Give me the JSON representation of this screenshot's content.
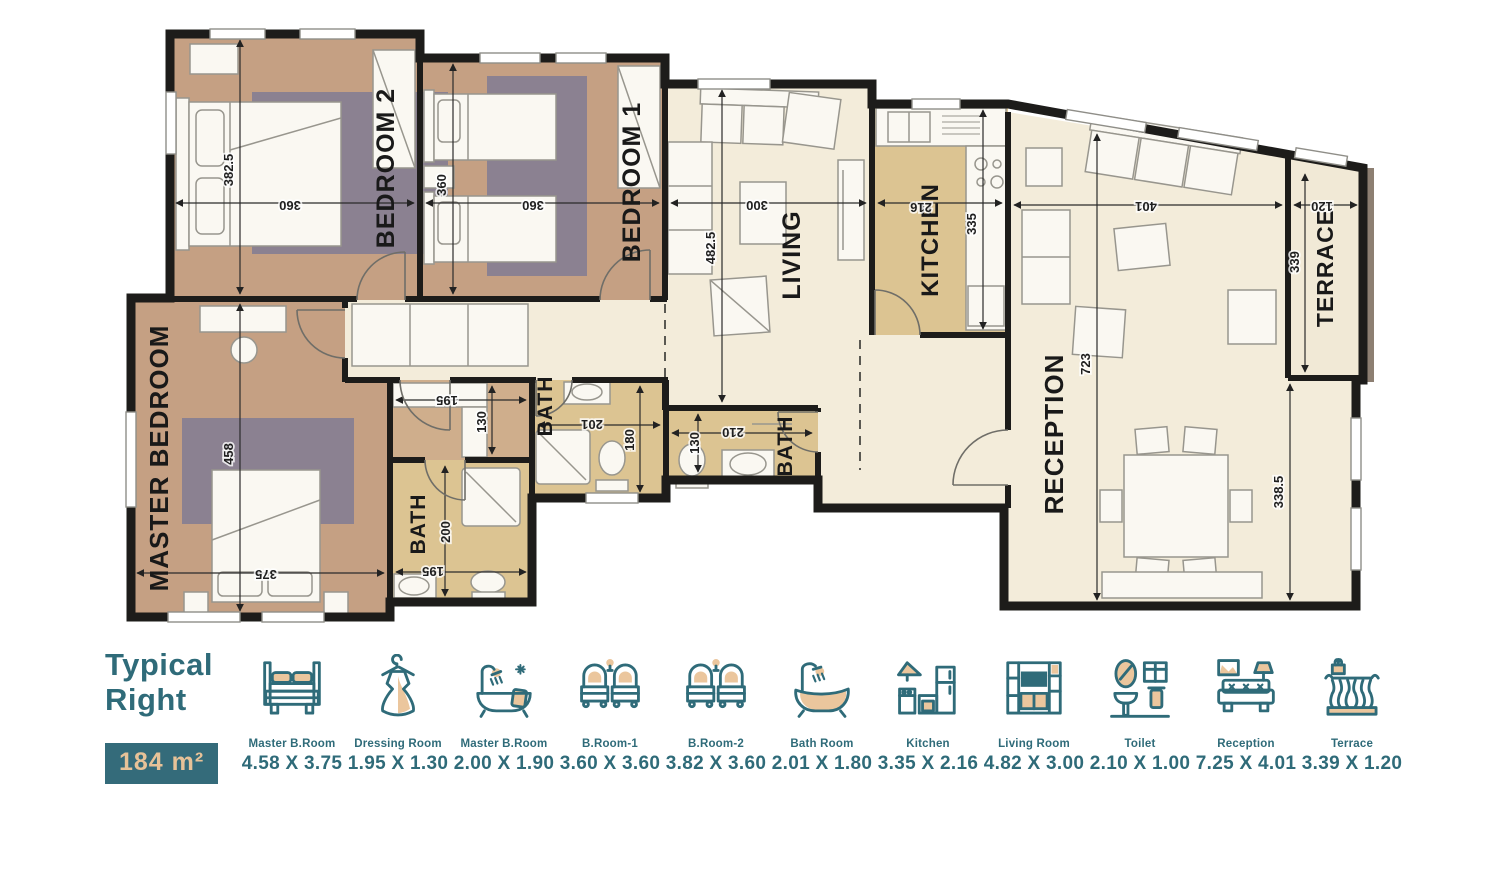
{
  "title": {
    "line1": "Typical",
    "line2": "Right",
    "area": "184 m²"
  },
  "floor_plan": {
    "room_labels": {
      "bedroom2": "BEDROOM 2",
      "bedroom1": "BEDROOM 1",
      "living": "LIVING",
      "kitchen": "KITCHEN",
      "reception": "RECEPTION",
      "terrace": "TERRACE",
      "master_bedroom": "MASTER BEDROOM",
      "master_bath": "BATH",
      "bath1": "BATH",
      "bath2": "BATH"
    },
    "dimensions": {
      "bedroom2_v": "382.5",
      "bedroom2_h": "360",
      "bedroom1_v": "360",
      "bedroom1_h": "360",
      "living_v": "482.5",
      "living_h": "300",
      "kitchen_h": "216",
      "kitchen_v": "335",
      "reception_h": "401",
      "reception_v": "723",
      "reception_v2": "338.5",
      "terrace_h": "120",
      "terrace_v": "339",
      "master_v": "458",
      "master_h": "375",
      "dressing_h": "195",
      "dressing_v": "130",
      "mbath_v": "200",
      "mbath_h": "195",
      "bath1_h": "201",
      "bath1_v": "180",
      "bath2_v": "130",
      "bath2_h": "210"
    }
  },
  "legend": {
    "items": [
      {
        "icon": "double-bed-icon",
        "name": "Master B.Room",
        "size": "4.58 X 3.75"
      },
      {
        "icon": "dress-icon",
        "name": "Dressing Room",
        "size": "1.95 X 1.30"
      },
      {
        "icon": "bathtub-shower-icon",
        "name": "Master B.Room",
        "size": "2.00 X 1.90"
      },
      {
        "icon": "twin-beds-icon",
        "name": "B.Room-1",
        "size": "3.60 X 3.60"
      },
      {
        "icon": "twin-beds-icon",
        "name": "B.Room-2",
        "size": "3.82 X 3.60"
      },
      {
        "icon": "bathtub-icon",
        "name": "Bath Room",
        "size": "2.01 X 1.80"
      },
      {
        "icon": "kitchen-icon",
        "name": "Kitchen",
        "size": "3.35 X 2.16"
      },
      {
        "icon": "living-room-icon",
        "name": "Living Room",
        "size": "4.82 X 3.00"
      },
      {
        "icon": "vanity-icon",
        "name": "Toilet",
        "size": "2.10 X 1.00"
      },
      {
        "icon": "sofa-icon",
        "name": "Reception",
        "size": "7.25 X 4.01"
      },
      {
        "icon": "terrace-icon",
        "name": "Terrace",
        "size": "3.39 X 1.20"
      }
    ]
  },
  "colors": {
    "teal": "#2f6b79",
    "tan": "#ebc69d",
    "wall": "#1d1c1a",
    "bedroom_floor": "#c5a083",
    "bath_floor": "#dcc492",
    "living_floor": "#f3ecda",
    "rug": "#8b8191"
  }
}
